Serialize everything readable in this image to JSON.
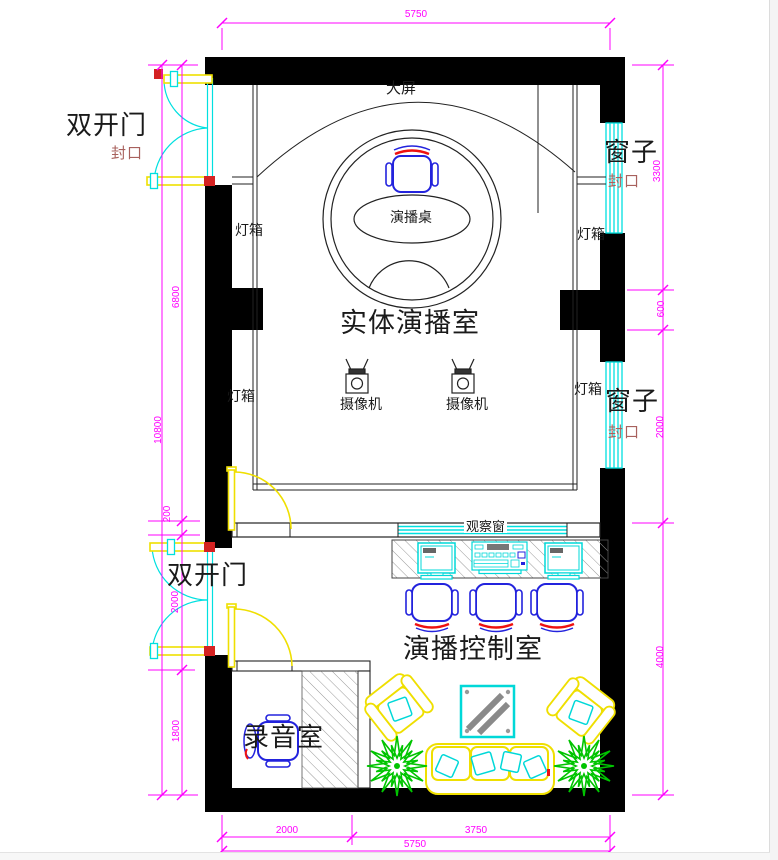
{
  "drawing": {
    "rooms": {
      "studio": "实体演播室",
      "control_room": "演播控制室",
      "recording_room": "录音室"
    },
    "annotations": {
      "big_screen": "大屏",
      "stage_desk": "演播桌",
      "camera": "摄像机",
      "light_box": "灯箱",
      "observation_window": "观察窗",
      "double_door": "双开门",
      "window": "窗子",
      "seal": "封口"
    },
    "dimensions": {
      "top_width": "5750",
      "bottom_segments": [
        "2000",
        "3750"
      ],
      "bottom_total": "5750",
      "left_segments": [
        "6800",
        "200",
        "2000",
        "1800"
      ],
      "left_total": "10800",
      "right_segments": [
        "3300",
        "600",
        "2000",
        "4000"
      ]
    },
    "colors": {
      "wall": "#000000",
      "dimension": "#ff00ff",
      "seal_text": "#a8615d",
      "door_leaf": "#efdf00",
      "door_swing": "#00e0e0",
      "window_glass": "#00e0e0",
      "furniture_blue": "#2323dd",
      "cushion_red": "#ee1111",
      "equipment_cyan": "#00d8d8",
      "sofa_yellow": "#efdf00",
      "plant_green": "#00c400"
    }
  }
}
